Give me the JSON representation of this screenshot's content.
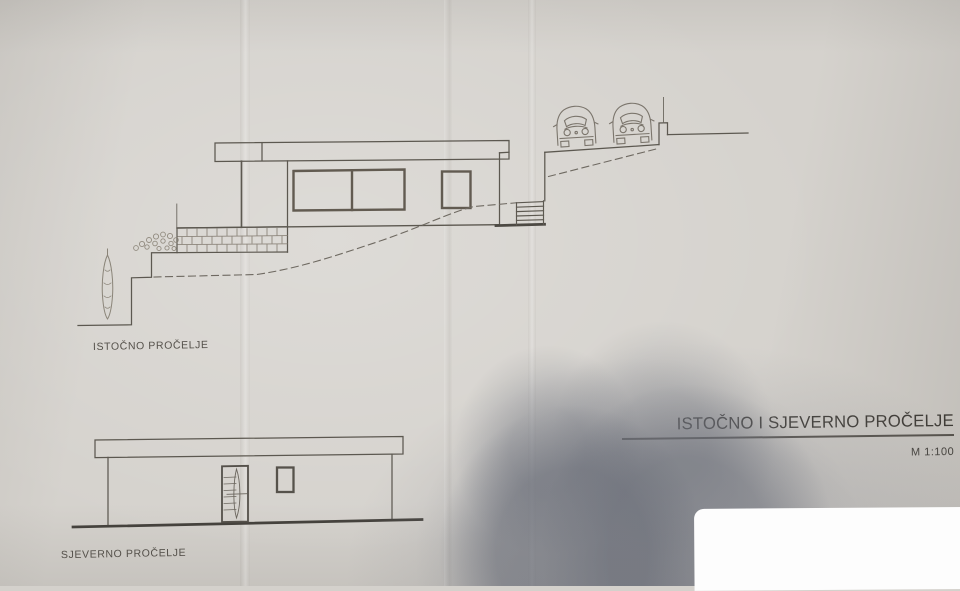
{
  "photo": {
    "east_elevation_label": "ISTOČNO PROČELJE",
    "north_elevation_label": "SJEVERNO PROČELJE",
    "title_block": {
      "title": "ISTOČNO I SJEVERNO PROČELJE",
      "scale": "M 1:100"
    },
    "icons": {
      "car": "car-front-outline",
      "tree": "cypress-tree-outline",
      "shrub": "shrub-scribble"
    },
    "colors": {
      "paper": "#d5d2cd",
      "ink": "#5c5850",
      "dashed_terrain": "#6e6961",
      "masonry": "#8d867c",
      "shadow": "#9b9da4",
      "white_patch": "#fdfdfd"
    }
  }
}
